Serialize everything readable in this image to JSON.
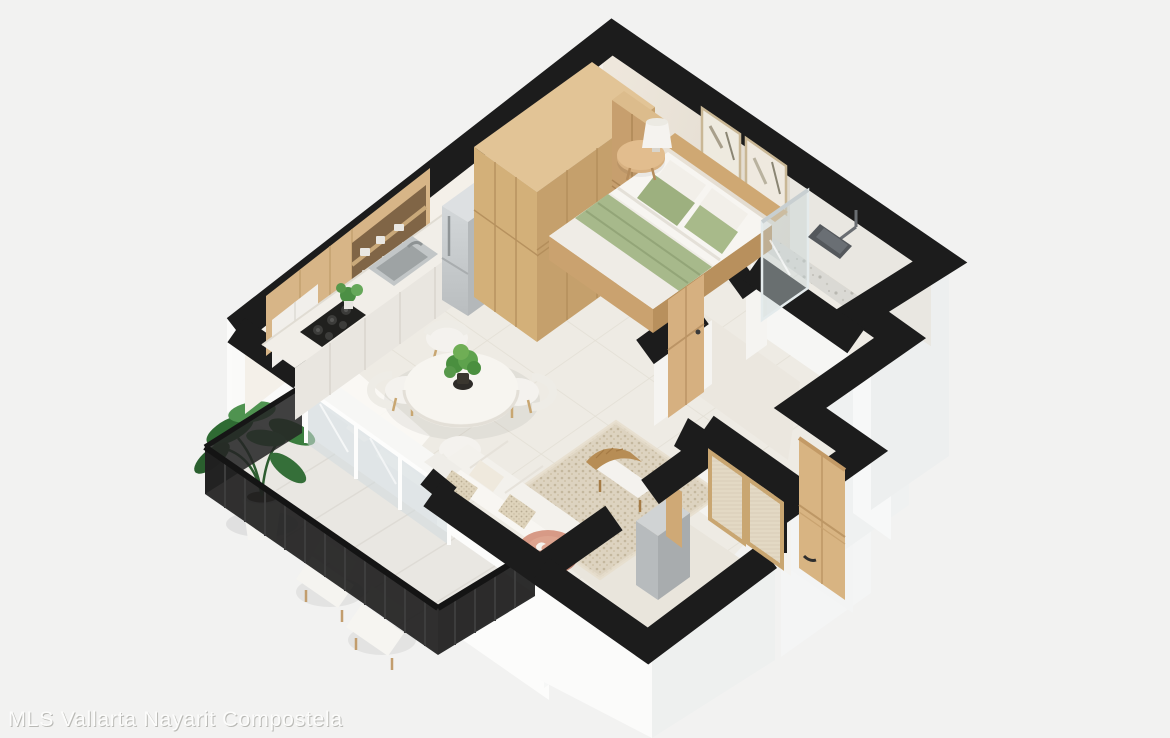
{
  "watermark": {
    "text": "MLS Vallarta Nayarit Compostela"
  },
  "scene": {
    "type": "3d-isometric-floor-plan-render",
    "subject": "one-bedroom apartment with balcony",
    "background_color": "#f2f2f1",
    "wall_top_color": "#1c1c1c",
    "exterior_wall_color": "#fafafa",
    "interior_wall_color": "#e9e2d7",
    "floor_color": "#eeebe4",
    "bathroom_floor_color": "#dad9d4",
    "wood_color": "#d2ae7c",
    "green_accent_color": "#a3b587",
    "rug_color": "#ddd3c0",
    "coffee_table_color": "#d79a86",
    "rooms": [
      {
        "name": "kitchen",
        "objects": [
          "wood upper cabinets",
          "open shelves with dishes",
          "counter with stainless sink",
          "gas stove",
          "potted plant",
          "stainless refrigerator"
        ]
      },
      {
        "name": "living-dining",
        "objects": [
          "round dining table",
          "four white chairs",
          "table plant",
          "white sofa with pillows",
          "speckled area rug",
          "rattan bench",
          "pink round coffee table",
          "sheer curtain",
          "sliding glass door"
        ]
      },
      {
        "name": "bedroom",
        "objects": [
          "double bed with green bedding",
          "wood headboard",
          "large wood wardrobe",
          "round side table",
          "table lamp",
          "two framed wall artworks",
          "wood door"
        ]
      },
      {
        "name": "bathroom",
        "objects": [
          "walk-in shower",
          "glass shower panel",
          "rain shower head",
          "terrazzo floor"
        ]
      },
      {
        "name": "hallway",
        "objects": [
          "closet with cane doors"
        ]
      },
      {
        "name": "entry",
        "objects": [
          "wood entry door",
          "utility appliance box",
          "wood pillar"
        ]
      },
      {
        "name": "balcony",
        "objects": [
          "black metal railing",
          "banana plant in white pot",
          "two white loungers",
          "tiled deck"
        ]
      }
    ]
  }
}
